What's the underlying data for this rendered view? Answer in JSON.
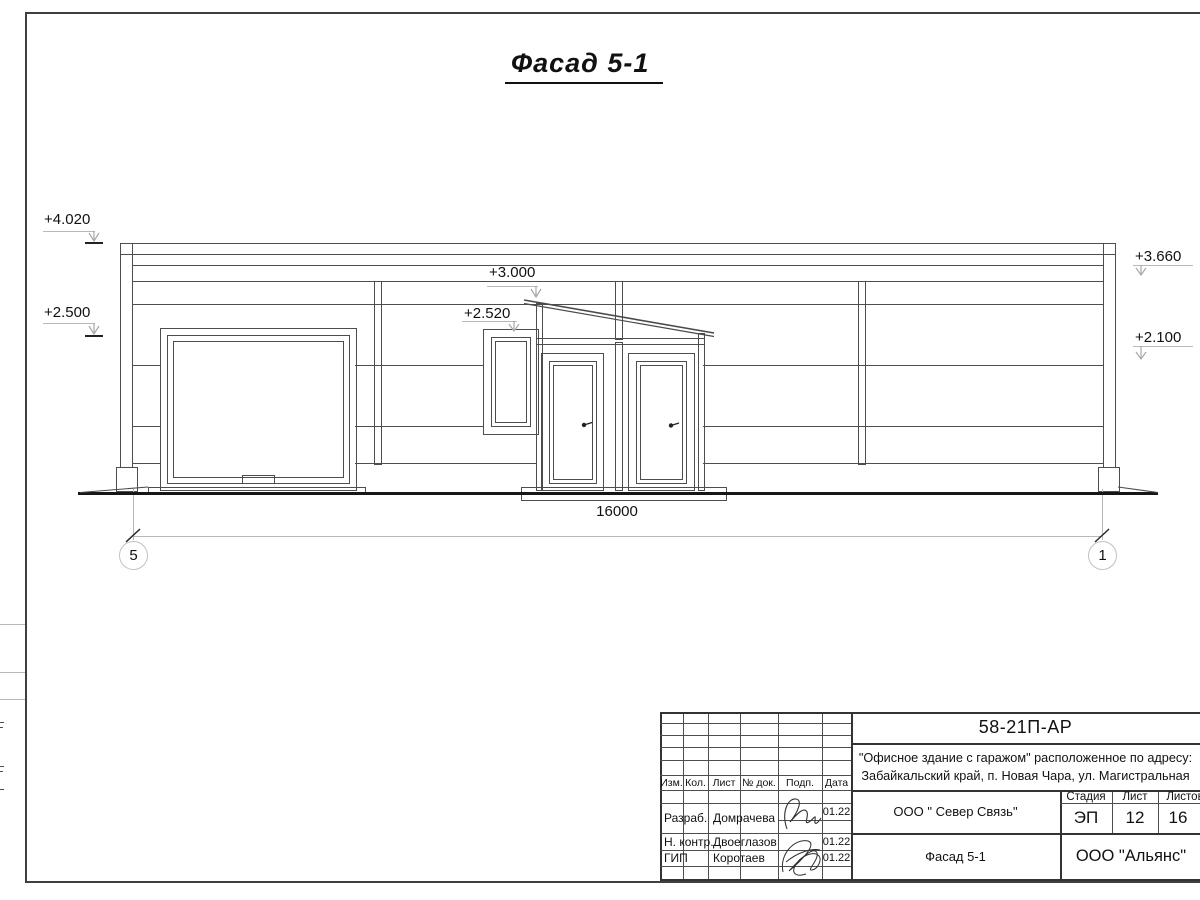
{
  "sheet": {
    "title": "Фасад 5-1",
    "dimension_total": "16000",
    "axis_markers": {
      "left": "5",
      "right": "1"
    },
    "elevation_marks": {
      "left_top": "+4.020",
      "left_mid": "+2.500",
      "canopy": "+3.000",
      "window": "+2.520",
      "right_top": "+3.660",
      "right_mid": "+2.100"
    }
  },
  "title_block": {
    "doc_number": "58-21П-АР",
    "project_line1": "\"Офисное здание с гаражом\" расположенное по адресу:",
    "project_line2": "Забайкальский край, п. Новая Чара, ул. Магистральная",
    "col_headers": {
      "izm": "Изм.",
      "kol": "Кол.",
      "list": "Лист",
      "doc": "№ док.",
      "sign": "Подп.",
      "date": "Дата"
    },
    "rows": {
      "developer": {
        "role": "Разраб.",
        "name": "Домрачева",
        "date": "01.22"
      },
      "norm_control": {
        "role": "Н. контр.",
        "name": "Двоеглазов",
        "date": "01.22"
      },
      "chief": {
        "role": "ГИП",
        "name": "Коротаев",
        "date": "01.22"
      }
    },
    "company": "ООО \" Север Связь\"",
    "sheet_name": "Фасад 5-1",
    "stage_header": {
      "stage": "Стадия",
      "sheet": "Лист",
      "sheets": "Листов"
    },
    "stage_values": {
      "stage": "ЭП",
      "sheet": "12",
      "sheets": "16"
    },
    "contractor": "ООО \"Альянс\""
  }
}
